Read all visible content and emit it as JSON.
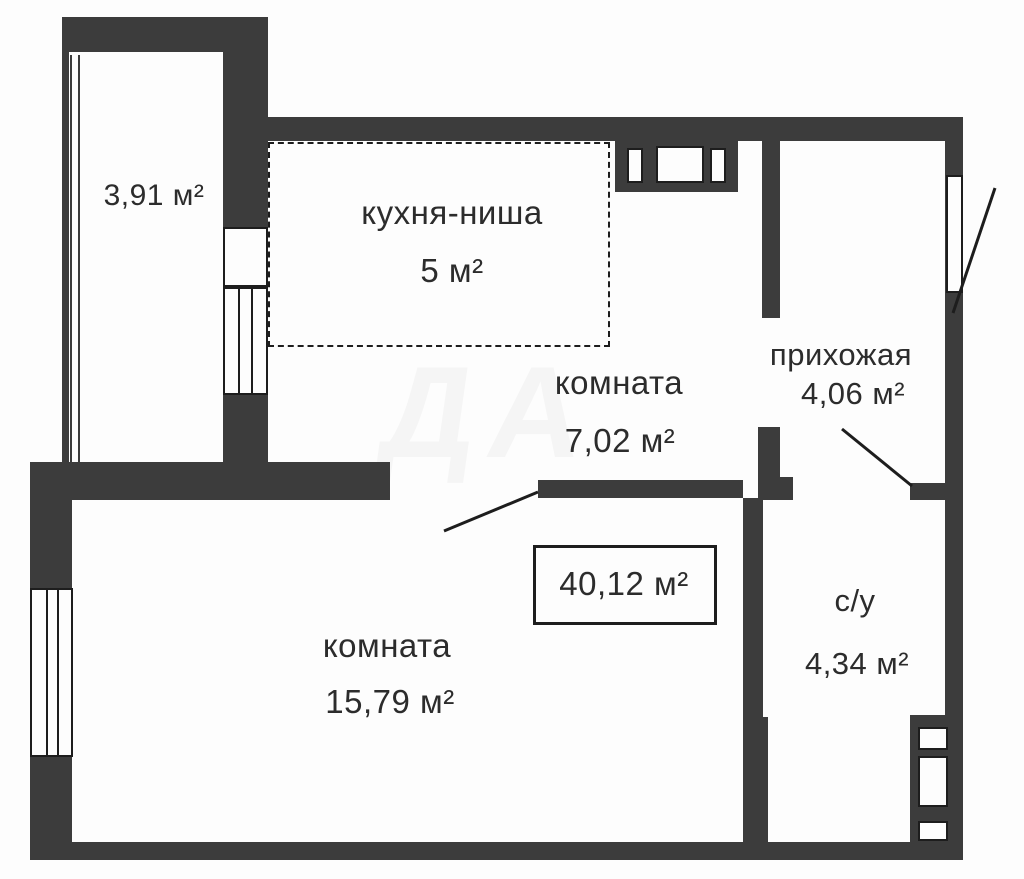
{
  "plan_title": "floor-plan",
  "colors": {
    "wall": "#3c3c3c",
    "line": "#1d1d1d",
    "text": "#2c2c2c",
    "bg": "#fdfdfd"
  },
  "total_area": {
    "value": "40,12 м²"
  },
  "rooms": [
    {
      "id": "balcony",
      "name": "",
      "area": "3,91 м²"
    },
    {
      "id": "kitchen",
      "name": "кухня-ниша",
      "area": "5 м²"
    },
    {
      "id": "room-small",
      "name": "комната",
      "area": "7,02 м²"
    },
    {
      "id": "hallway",
      "name": "прихожая",
      "area": "4,06 м²"
    },
    {
      "id": "room-large",
      "name": "комната",
      "area": "15,79 м²"
    },
    {
      "id": "bathroom",
      "name": "с/у",
      "area": "4,34 м²"
    }
  ],
  "watermark": "ДА"
}
